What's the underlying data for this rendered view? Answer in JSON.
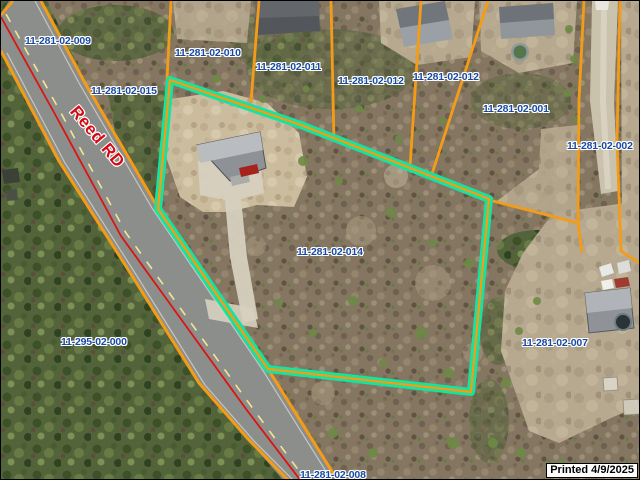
{
  "map": {
    "road_name": "Reed RD",
    "selected_parcel_id": "11-281-02-014",
    "printed_note": "Printed 4/9/2025",
    "parcel_labels": {
      "p009": "11-281-02-009",
      "p015": "11-281-02-015",
      "p010": "11-281-02-010",
      "p011": "11-281-02-011",
      "p012a": "11-281-02-012",
      "p012b": "11-281-02-012",
      "p001": "11-281-02-001",
      "p002": "11-281-02-002",
      "p014": "11-281-02-014",
      "p007": "11-281-02-007",
      "p000": "11-295-02-000",
      "p008": "11-281-02-008"
    },
    "colors": {
      "parcel_boundary": "#f49c15",
      "selected_highlight": "#14e3a1",
      "parcel_label_text": "#1a4aa0",
      "road_centerline": "#dc1411",
      "road_label_text": "#d40a12"
    }
  }
}
